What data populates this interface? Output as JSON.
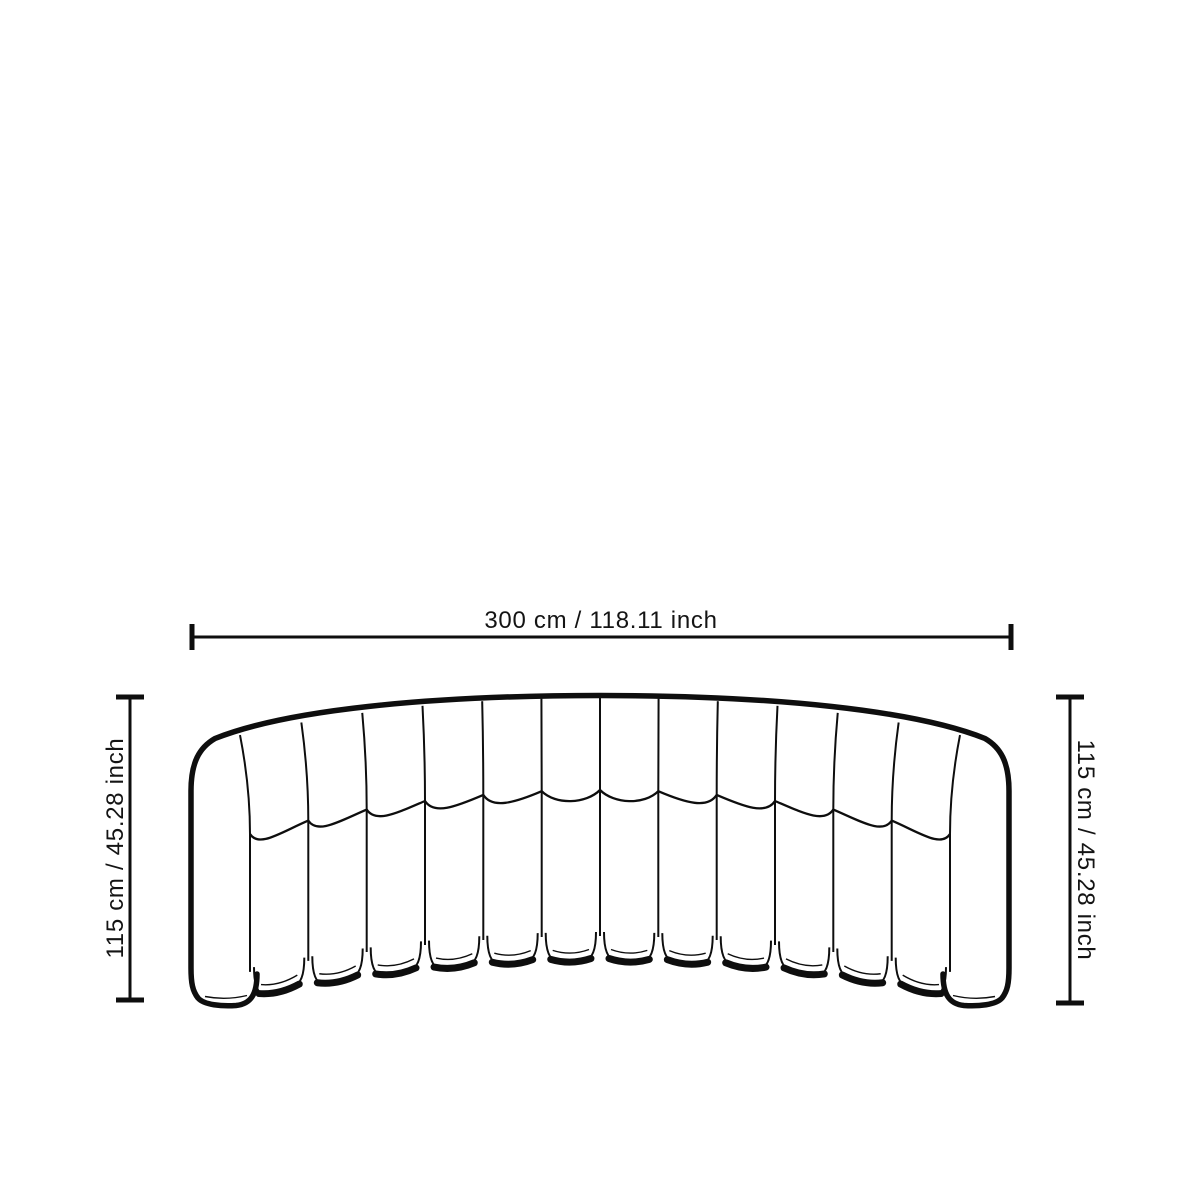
{
  "background": "#ffffff",
  "line_color": "#0e0e0e",
  "text_color": "#141414",
  "figure": {
    "name": "curved-channel-sofa-front-elevation",
    "channel_count": 14
  },
  "dimensions": {
    "width": {
      "label": "300 cm / 118.11 inch",
      "value_cm": 300,
      "value_inch": 118.11
    },
    "height_left": {
      "label": "115 cm / 45.28 inch",
      "value_cm": 115,
      "value_inch": 45.28
    },
    "height_right": {
      "label": "115 cm / 45.28 inch",
      "value_cm": 115,
      "value_inch": 45.28
    }
  }
}
